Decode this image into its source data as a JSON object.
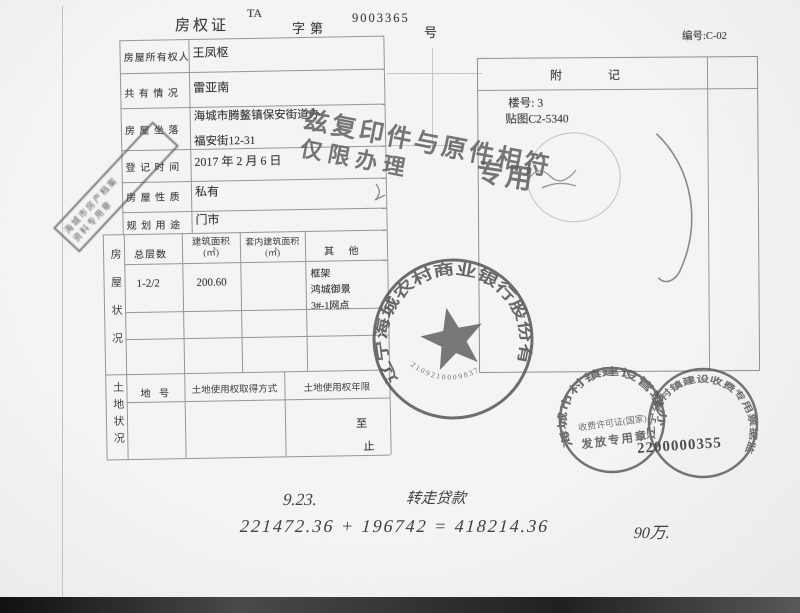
{
  "header": {
    "doc_type": "房权证",
    "series": "TA",
    "word": "字第",
    "number": "9003365",
    "suffix": "号",
    "ref_no": "编号:C-02"
  },
  "owner_row": {
    "label": "房屋所有权人",
    "value": "王凤枢"
  },
  "coowner_row": {
    "label": "共 有 情 况",
    "value": "雷亚南"
  },
  "location_row": {
    "label": "房 屋 坐 落",
    "line1": "海城市腾鳌镇保安街道办",
    "line2": "福安街12-31"
  },
  "regdate_row": {
    "label": "登 记 时 间",
    "value": "2017 年 2 月 6 日"
  },
  "nature_row": {
    "label": "房 屋 性 质",
    "value": "私有"
  },
  "usage_row": {
    "label": "规 划 用 途",
    "value": "门市"
  },
  "house_section": {
    "side_label": "房屋状况",
    "col_floors": "总层数",
    "col_area1": "建筑面积",
    "col_area1_unit": "(㎡)",
    "col_area2": "套内建筑面积",
    "col_area2_unit": "(㎡)",
    "col_other": "其  他",
    "floors": "1-2/2",
    "area": "200.60",
    "other1": "框架",
    "other2": "鸿城御景",
    "other3": "3#-1网点"
  },
  "land_section": {
    "side_label": "土地状况",
    "col_parcel": "地 号",
    "col_method": "土地使用权取得方式",
    "col_term": "土地使用权年限",
    "term_to": "至",
    "term_end": "止"
  },
  "attachment": {
    "title": "附记",
    "line1": "楼号: 3",
    "line2": "贴图C2-5340"
  },
  "copy_stamp": {
    "line1": "兹复印件与原件相符",
    "line2": "仅限办理",
    "note": "专用"
  },
  "archive_stamp": {
    "line1": "海城市房产档案",
    "line2": "资料专用章"
  },
  "bank_seal": {
    "ring_text": "辽宁海城农村商业银行股份有限公司",
    "serial": "2109210009837"
  },
  "fee_seal": {
    "ring_text": "海城市村镇建设管理办",
    "line1": "收费许可证(国家)",
    "line2": "发放专用章"
  },
  "invoice_seal": {
    "ring_text": "辽宁省村镇建设收费专用票据监制",
    "serial": "2200000355"
  },
  "handwriting": {
    "date": "9.23.",
    "phrase": "转走贷款",
    "equation": "221472.36 + 196742 = 418214.36",
    "amount": "90万."
  },
  "colors": {
    "ink": "#3e3e3e",
    "stamp": "#5a5a5a",
    "paper": "#f2f2f0"
  }
}
